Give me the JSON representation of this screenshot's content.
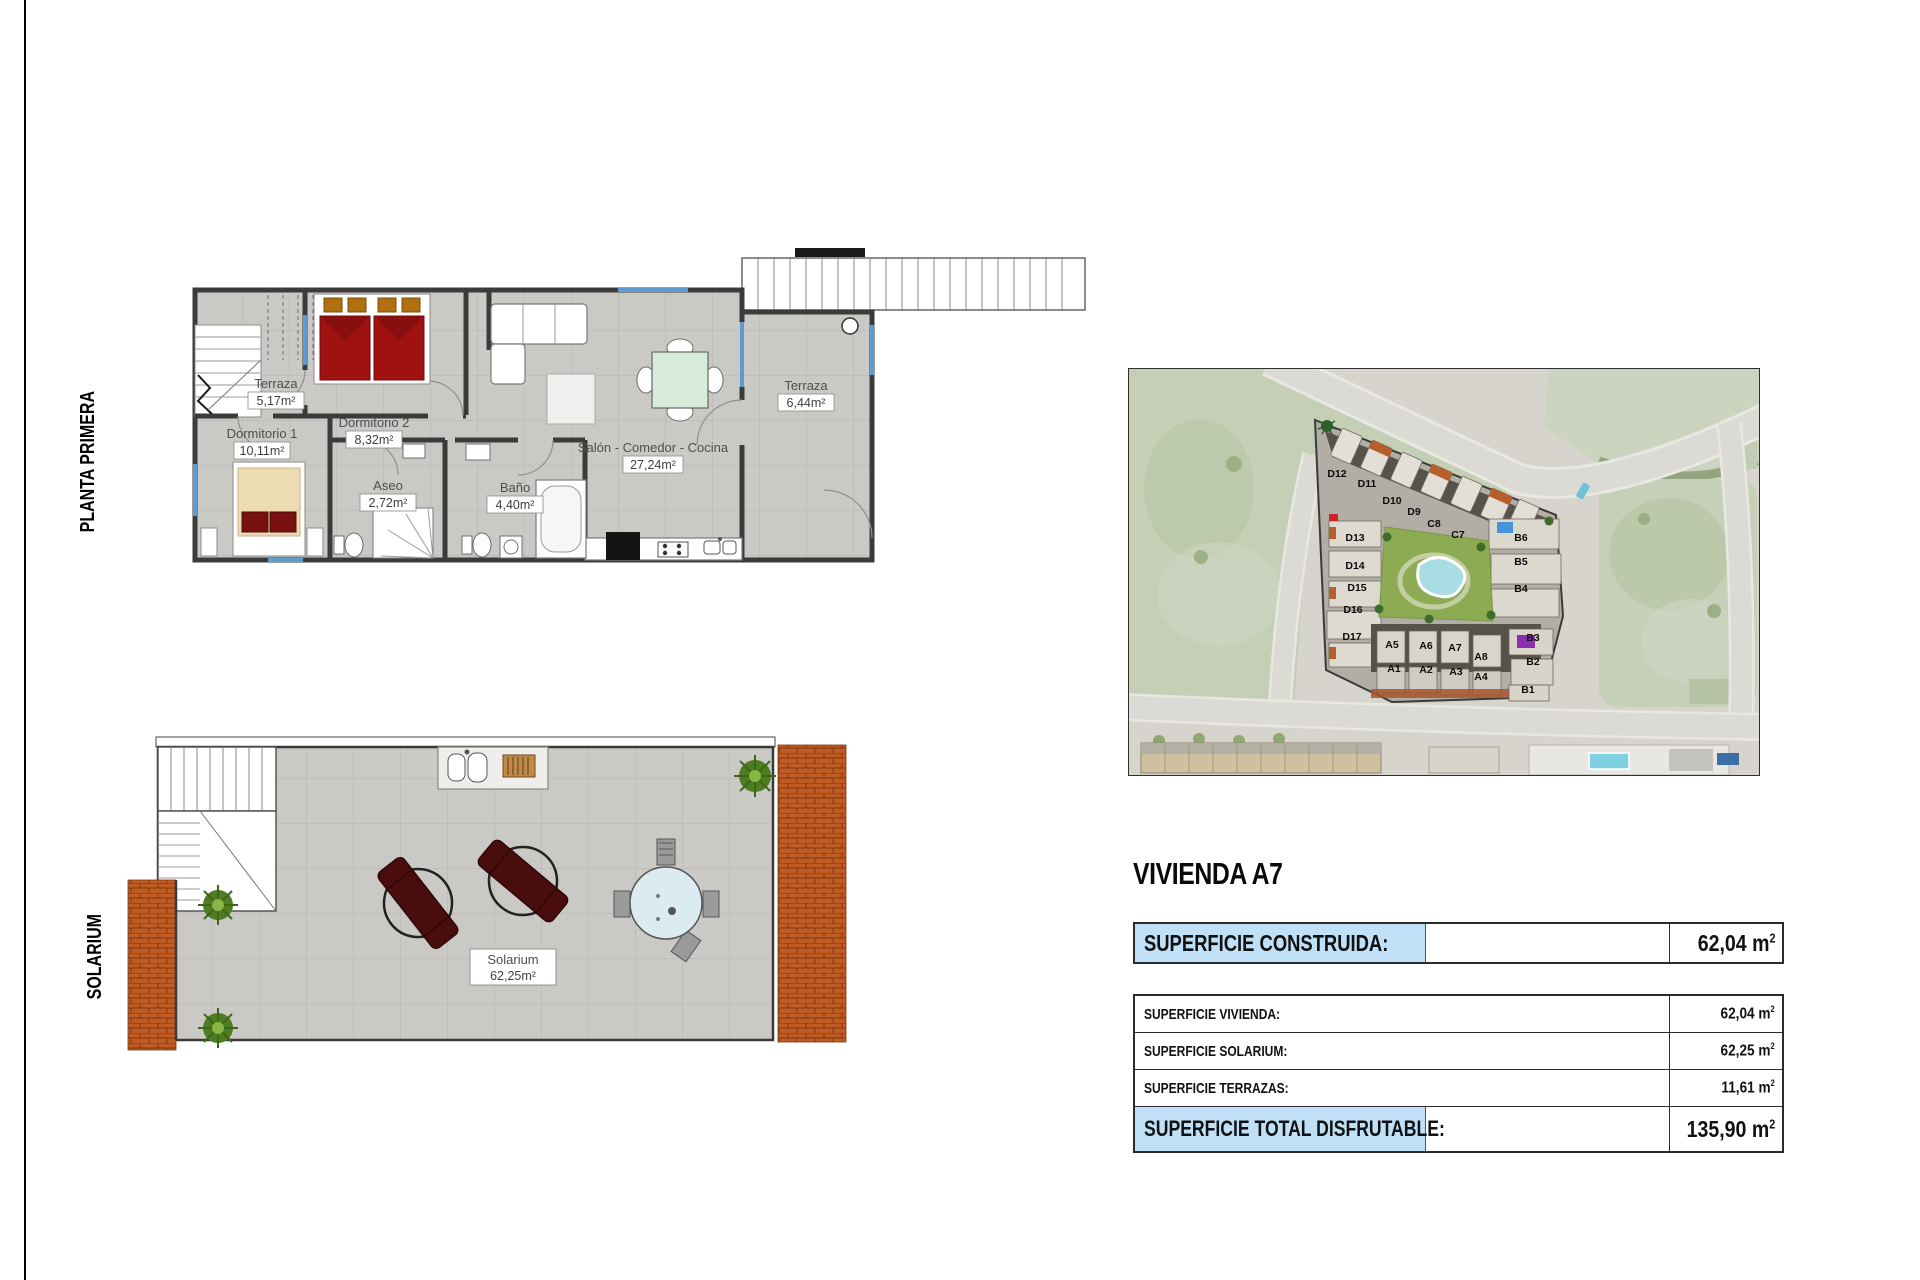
{
  "page": {
    "left_label_top": "PLANTA PRIMERA",
    "left_label_bottom": "SOLARIUM"
  },
  "plans": {
    "planta_primera": {
      "rooms": {
        "terraza_top": {
          "name": "Terraza",
          "area": "5,17m²"
        },
        "dormitorio2": {
          "name": "Dormitorio 2",
          "area": "8,32m²"
        },
        "salon": {
          "name": "Salón - Comedor - Cocina",
          "area": "27,24m²"
        },
        "terraza_right": {
          "name": "Terraza",
          "area": "6,44m²"
        },
        "dormitorio1": {
          "name": "Dormitorio 1",
          "area": "10,11m²"
        },
        "aseo": {
          "name": "Aseo",
          "area": "2,72m²"
        },
        "bano": {
          "name": "Baño",
          "area": "4,40m²"
        }
      }
    },
    "solarium": {
      "room": {
        "name": "Solarium",
        "area": "62,25m²"
      }
    }
  },
  "map": {
    "labels": [
      "D12",
      "D11",
      "D10",
      "D9",
      "C8",
      "C7",
      "D13",
      "D14",
      "D15",
      "D16",
      "D17",
      "B6",
      "B5",
      "B4",
      "B3",
      "B2",
      "B1",
      "A5",
      "A6",
      "A7",
      "A8",
      "A1",
      "A2",
      "A3",
      "A4"
    ],
    "highlight_unit": "A7"
  },
  "summary": {
    "title": "VIVIENDA A7",
    "unit": "m",
    "exp": "2",
    "highlight_color": "#bfe0f7",
    "construida": {
      "label": "SUPERFICIE CONSTRUIDA:",
      "value": "62,04"
    },
    "rows": [
      {
        "label": "SUPERFICIE VIVIENDA:",
        "value": "62,04"
      },
      {
        "label": "SUPERFICIE SOLARIUM:",
        "value": "62,25"
      },
      {
        "label": "SUPERFICIE TERRAZAS:",
        "value": "11,61"
      }
    ],
    "total": {
      "label": "SUPERFICIE TOTAL DISFRUTABLE:",
      "value": "135,90"
    }
  }
}
